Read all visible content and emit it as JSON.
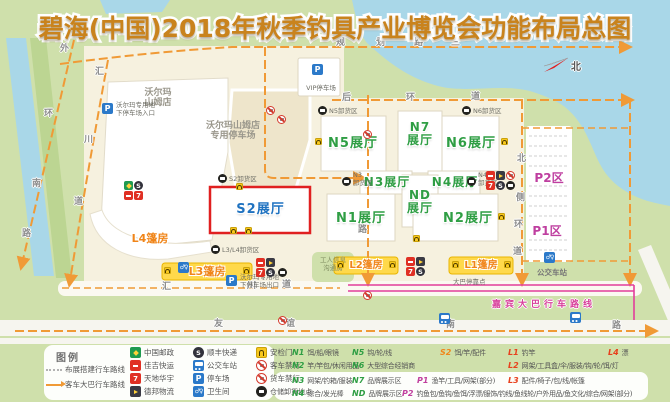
{
  "title": "碧海(中国)2018年秋季钓具产业博览会功能布局总图",
  "compass": "北",
  "colors": {
    "title_orange": "#c9831d",
    "hall_green": "#2f9e44",
    "s2_blue": "#1f72c0",
    "zone_magenta": "#bf3fa0",
    "tent_orange": "#f08519",
    "road_orange": "#f09a36",
    "guest_route_magenta": "#e23d9b",
    "water": "#a9d7e8",
    "grass": "#cfe0ab",
    "s2_border_red": "#e02020"
  },
  "roads": {
    "guihua_lu_san": [
      "规",
      "划",
      "路",
      "三"
    ],
    "waihuan_nanlu": [
      "外",
      "环",
      "南",
      "路"
    ],
    "huichuan_dao_v": [
      "汇",
      "川",
      "道"
    ],
    "huichuan_dao_h": [
      "汇",
      "川",
      "道"
    ],
    "houhuan_dao": [
      "后",
      "环",
      "道"
    ],
    "beice_huandao": [
      "北",
      "侧",
      "环",
      "道"
    ],
    "mid_road": [
      "路"
    ],
    "youyi_nanlu": [
      "友",
      "谊",
      "南",
      "路"
    ],
    "guest_bus_route": "嘉宾大巴行车路线"
  },
  "halls": {
    "n1": "N1展厅",
    "n2": "N2展厅",
    "n3": "N3展厅",
    "n4": "N4展厅",
    "n5": "N5展厅",
    "n6": "N6展厅",
    "n7": [
      "N7",
      "展厅"
    ],
    "nd": [
      "ND",
      "展厅"
    ],
    "s2": "S2展厅"
  },
  "tents": {
    "l1": "L1篷房",
    "l2": "L2篷房",
    "l3": "L3篷房",
    "l4": "L4篷房"
  },
  "parking_zones": {
    "p1": "P1区",
    "p2": "P2区"
  },
  "walmart": {
    "store": [
      "沃尔玛",
      "山姆店"
    ],
    "parking": [
      "沃尔玛山姆店",
      "专用停车场"
    ],
    "entrance": [
      "沃尔玛专用地",
      "下停车场入口"
    ],
    "exit": [
      "沃尔玛专用地",
      "下停车场出口"
    ],
    "vip": "VIP停车场"
  },
  "unload": {
    "s2": "S2卸货区",
    "l3l4": "L3/L4卸货区",
    "n3": [
      "N3",
      "卸货区"
    ],
    "n4": [
      "N4",
      "卸货区"
    ],
    "n5": "N5卸货区",
    "n6": "N6卸货区"
  },
  "facilities": {
    "bus_station": "公交车站",
    "bus_stop": "大巴停靠点",
    "worker_room": [
      "工人信息",
      "沟通房"
    ]
  },
  "legend": {
    "title": "图例",
    "routes": [
      {
        "label": "布展搭建行车路线"
      },
      {
        "label": "客车大巴行车路线"
      }
    ],
    "icon_columns": [
      {
        "items": [
          {
            "icon": "china-post",
            "label": "中国邮政"
          },
          {
            "icon": "jiaji-express",
            "label": "佳吉快运"
          },
          {
            "icon": "tiandi-huayu",
            "label": "天地华宇"
          },
          {
            "icon": "debang-logistics",
            "label": "德邦物流"
          }
        ]
      },
      {
        "items": [
          {
            "icon": "sf-express",
            "label": "顺丰快递"
          },
          {
            "icon": "bus-station",
            "label": "公交车站"
          },
          {
            "icon": "parking",
            "label": "停车场"
          },
          {
            "icon": "toilet",
            "label": "卫生间"
          }
        ]
      },
      {
        "items": [
          {
            "icon": "security-gate",
            "label": "安检门"
          },
          {
            "icon": "no-bus",
            "label": "客车禁行"
          },
          {
            "icon": "no-truck",
            "label": "货车禁行"
          },
          {
            "icon": "unload-point",
            "label": "仓储卸货地点"
          }
        ]
      }
    ],
    "zones": [
      {
        "code": "N1",
        "desc": "饵/船/眼镜",
        "type": "n"
      },
      {
        "code": "N2",
        "desc": "竿/竿包/休闲用品",
        "type": "n"
      },
      {
        "code": "N3",
        "desc": "网架/钓箱/服装",
        "type": "n"
      },
      {
        "code": "N4",
        "desc": "综合/发光棒",
        "type": "n"
      },
      {
        "code": "N5",
        "desc": "钩/轮/线",
        "type": "n"
      },
      {
        "code": "N6",
        "desc": "大型综合经销商",
        "type": "n"
      },
      {
        "code": "N7",
        "desc": "品牌展示区",
        "type": "n"
      },
      {
        "code": "ND",
        "desc": "品牌展示区",
        "type": "n"
      },
      {
        "code": "S2",
        "desc": "饵/竿/配件",
        "type": "s"
      },
      {
        "code": "L1",
        "desc": "钓竿",
        "type": "l"
      },
      {
        "code": "L4",
        "desc": "漂",
        "type": "l"
      },
      {
        "code": "L2",
        "desc": "网架/工具盒/伞/服装/钩/轮/饵/灯",
        "type": "l"
      },
      {
        "code": "P1",
        "desc": "渔竿/工具/网架(部分)",
        "type": "p"
      },
      {
        "code": "L3",
        "desc": "配件/椅子/包/线/帐篷",
        "type": "l"
      },
      {
        "code": "P2",
        "desc": "钓鱼包/鱼钩/鱼饵/浮漂/服饰/钓线/鱼线轮/户外用品/鱼文化/综合/网架(部分)",
        "type": "p"
      }
    ]
  }
}
